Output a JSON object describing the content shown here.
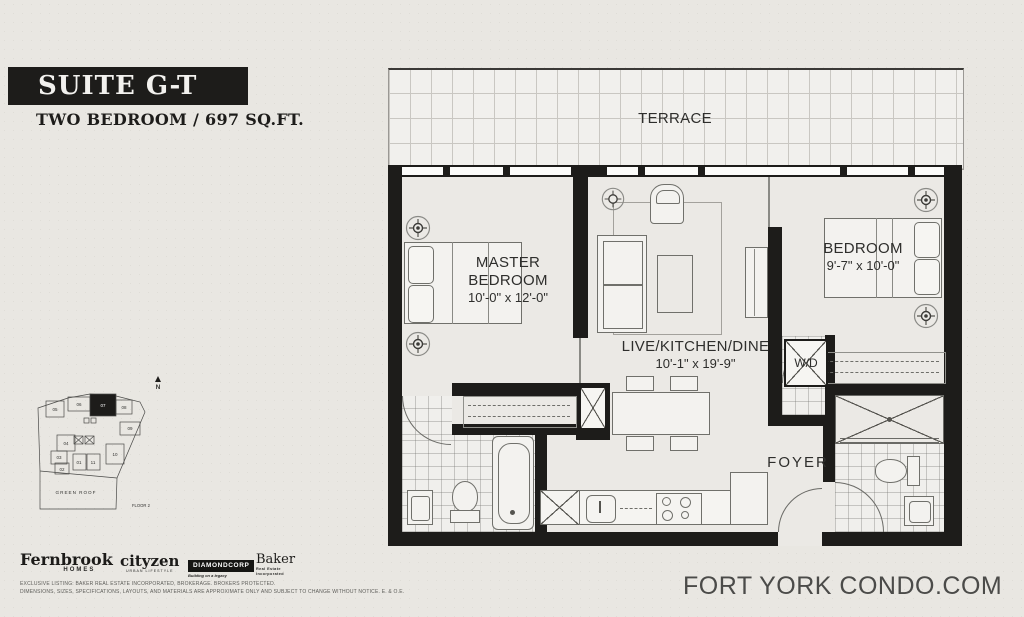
{
  "header": {
    "suite_name": "SUITE G-T",
    "suite_type": "TWO BEDROOM / 697 SQ.FT."
  },
  "floorplan": {
    "rooms": {
      "terrace": {
        "label": "TERRACE"
      },
      "master": {
        "label": "MASTER BEDROOM",
        "dims": "10'-0\" x 12'-0\""
      },
      "living": {
        "label": "LIVE/KITCHEN/DINE",
        "dims": "10'-1\" x 19'-9\""
      },
      "bedroom": {
        "label": "BEDROOM",
        "dims": "9'-7\" x 10'-0\""
      },
      "laundry": {
        "label": "W/D"
      },
      "foyer": {
        "label": "FOYER"
      }
    }
  },
  "keyplan": {
    "units": [
      "01",
      "02",
      "03",
      "04",
      "05",
      "06",
      "07",
      "08",
      "09",
      "10",
      "11"
    ],
    "highlighted_unit": "07",
    "green_roof_label": "GREEN ROOF",
    "floor_label": "FLOOR 2",
    "north_label": "N"
  },
  "developers": [
    {
      "name": "Fernbrook",
      "tagline": "HOMES"
    },
    {
      "name": "cityzen",
      "tagline": "URBAN LIFESTYLE"
    },
    {
      "name": "DIAMONDCORP",
      "tagline": "Building on a legacy"
    },
    {
      "name": "Baker",
      "tagline": "Real Estate Incorporated"
    }
  ],
  "disclaimer": {
    "line1": "EXCLUSIVE LISTING: BAKER REAL ESTATE INCORPORATED, BROKERAGE. BROKERS PROTECTED.",
    "line2": "DIMENSIONS, SIZES, SPECIFICATIONS, LAYOUTS, AND MATERIALS ARE APPROXIMATE ONLY AND SUBJECT TO CHANGE WITHOUT NOTICE. E. & O.E."
  },
  "footer": {
    "website": "FORT YORK CONDO.COM"
  },
  "colors": {
    "wall": "#1d1c1a",
    "banner": "#1d1c1a",
    "paper": "#e9e7e2",
    "footer_text": "#4b4b49"
  }
}
